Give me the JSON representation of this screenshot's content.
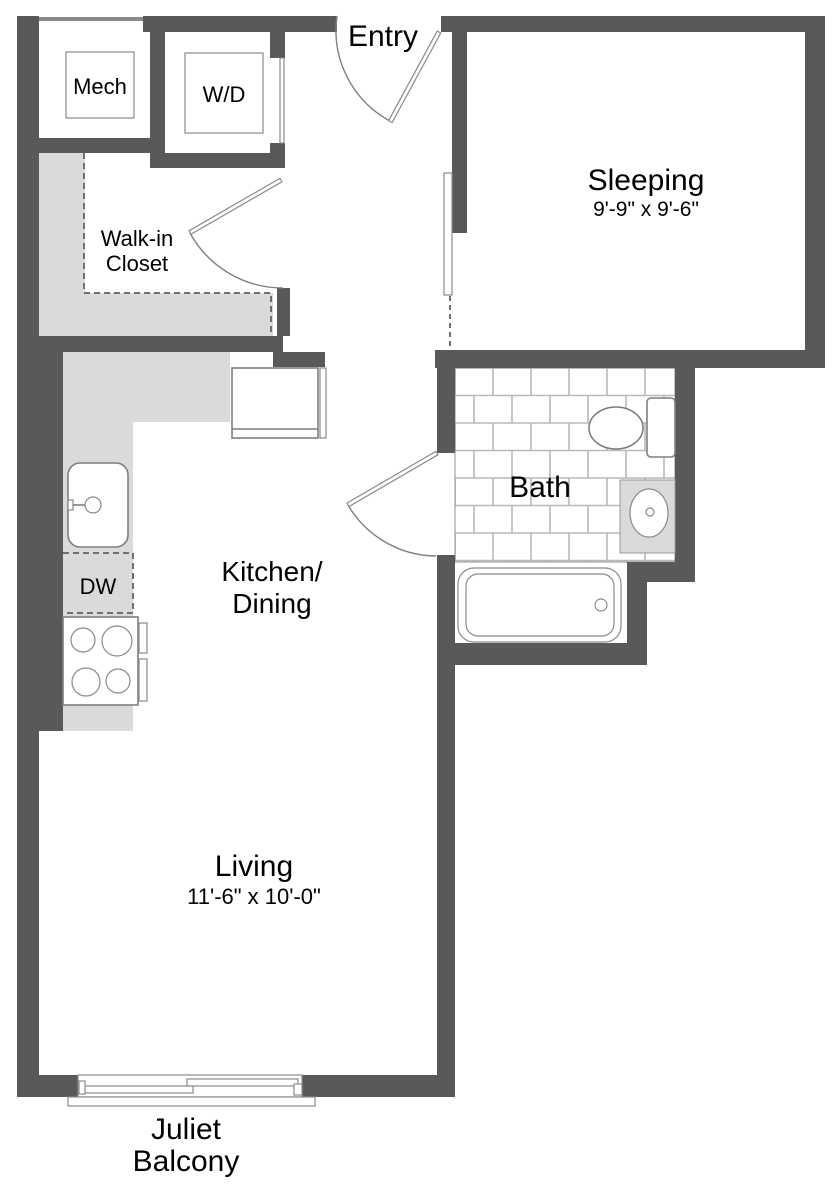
{
  "rooms": {
    "entry": {
      "label": "Entry"
    },
    "sleeping": {
      "label": "Sleeping",
      "dims": "9'-9\" x 9'-6\""
    },
    "closet": {
      "line1": "Walk-in",
      "line2": "Closet"
    },
    "kitchen": {
      "line1": "Kitchen/",
      "line2": "Dining"
    },
    "bath": {
      "label": "Bath"
    },
    "living": {
      "label": "Living",
      "dims": "11'-6\" x 10'-0\""
    },
    "balcony": {
      "line1": "Juliet",
      "line2": "Balcony"
    }
  },
  "fixtures": {
    "mech": "Mech",
    "washer_dryer": "W/D",
    "dishwasher": "DW"
  },
  "colors": {
    "wall": "#58595B",
    "counter_shelf": "#DADADA",
    "tile_grout": "#B9B9B9",
    "fixture_outline": "#7F7F7F",
    "text": "#000000"
  }
}
